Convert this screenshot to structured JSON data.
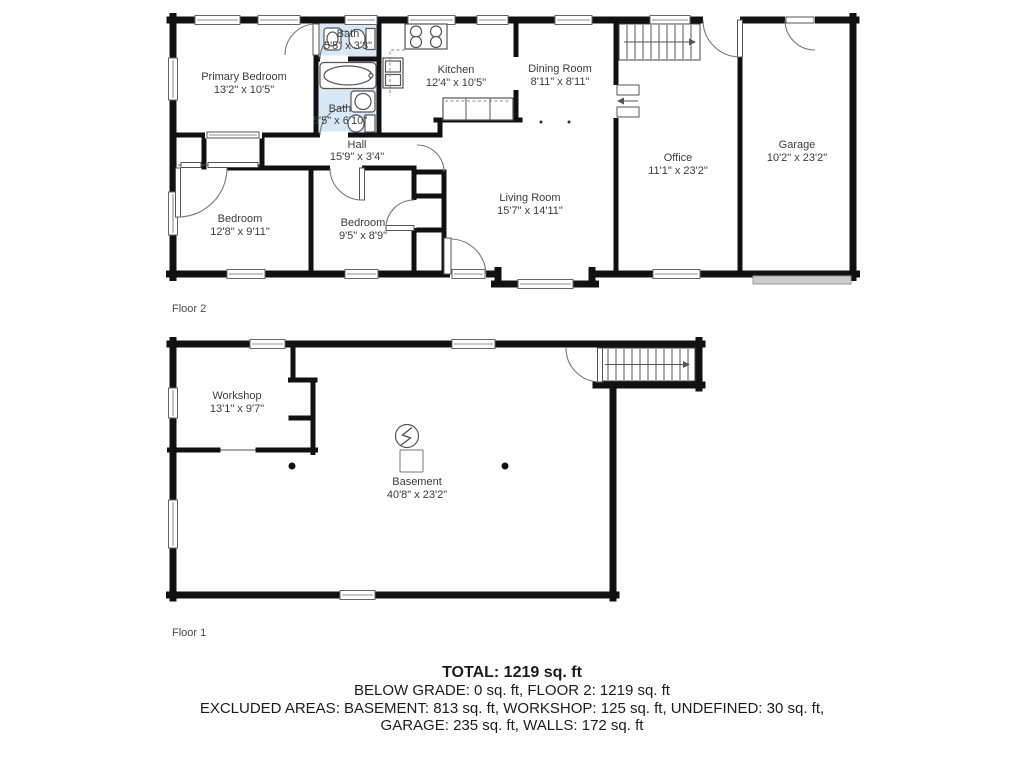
{
  "floor2": {
    "label": "Floor 2",
    "rooms": [
      {
        "name": "Primary Bedroom",
        "dims": "13'2\" x 10'5\""
      },
      {
        "name": "Bath",
        "dims": "5'5\" x 3'3\""
      },
      {
        "name": "Bath",
        "dims": "5'5\" x 6'10\""
      },
      {
        "name": "Kitchen",
        "dims": "12'4\" x 10'5\""
      },
      {
        "name": "Dining Room",
        "dims": "8'11\" x 8'11\""
      },
      {
        "name": "Hall",
        "dims": "15'9\" x 3'4\""
      },
      {
        "name": "Bedroom",
        "dims": "12'8\" x 9'11\""
      },
      {
        "name": "Bedroom",
        "dims": "9'5\" x 8'9\""
      },
      {
        "name": "Living Room",
        "dims": "15'7\" x 14'11\""
      },
      {
        "name": "Office",
        "dims": "11'1\" x 23'2\""
      },
      {
        "name": "Garage",
        "dims": "10'2\" x 23'2\""
      }
    ]
  },
  "floor1": {
    "label": "Floor 1",
    "rooms": [
      {
        "name": "Workshop",
        "dims": "13'1\" x 9'7\""
      },
      {
        "name": "Basement",
        "dims": "40'8\" x 23'2\""
      }
    ]
  },
  "summary": {
    "total_line": "TOTAL: 1219 sq. ft",
    "below_grade_line": "BELOW GRADE: 0 sq. ft, FLOOR 2: 1219 sq. ft",
    "excluded_line1": "EXCLUDED AREAS: BASEMENT: 813 sq. ft, WORKSHOP: 125 sq. ft, UNDEFINED: 30 sq. ft,",
    "excluded_line2": "GARAGE: 235 sq. ft, WALLS: 172 sq. ft"
  },
  "colors": {
    "wall": "#111111",
    "bath_fill": "#d9e8f6",
    "garage_door": "#cccccc",
    "label_text": "#3c3c3c"
  }
}
